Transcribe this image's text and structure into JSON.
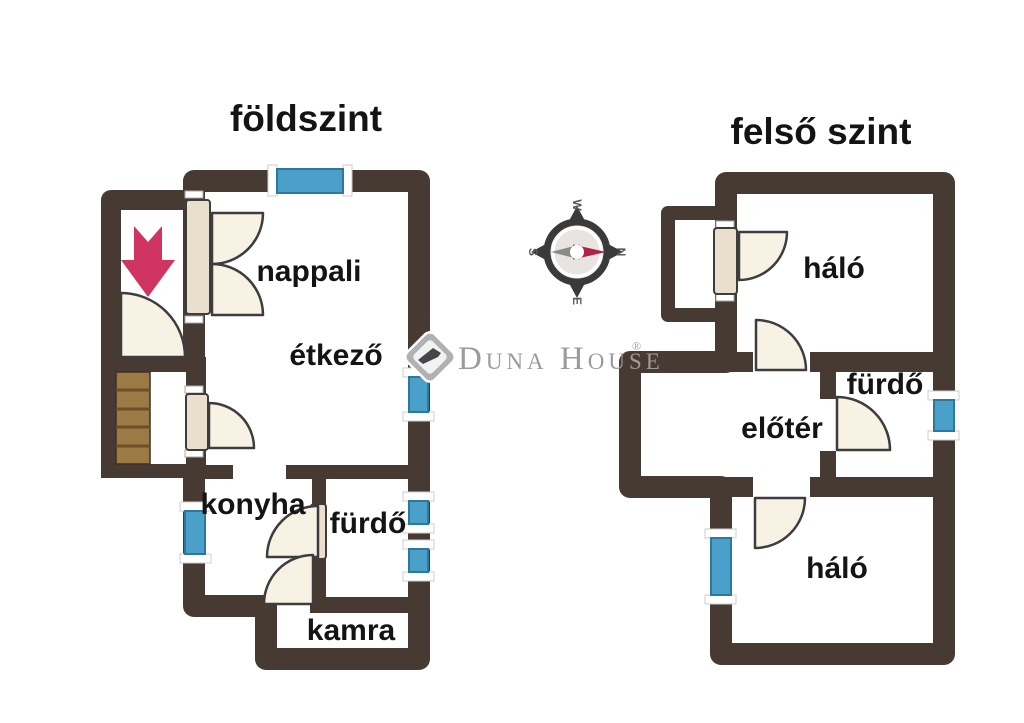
{
  "titles": {
    "ground": "földszint",
    "upper": "felső szint"
  },
  "rooms": {
    "nappali": "nappali",
    "etkezo": "étkező",
    "konyha": "konyha",
    "furdo_ground": "fürdő",
    "kamra": "kamra",
    "halo_upper_top": "háló",
    "eloter": "előtér",
    "furdo_upper": "fürdő",
    "halo_upper_bottom": "háló"
  },
  "compass": {
    "north": "N",
    "south": "S",
    "east": "E",
    "west": "W"
  },
  "watermark": {
    "brand": "Duna House",
    "registered": "®"
  },
  "colors": {
    "wall": "#473a32",
    "window": "#4aa0c8",
    "window_border": "#2e789f",
    "door_fill": "#f8f2e5",
    "door_panel": "#e9dfcc",
    "door_stroke": "#3d3d3d",
    "arrow": "#cf3560",
    "arrow_edge": "#b52a4e",
    "stairs": "#9b7a44",
    "stairs_line": "#6b4f28",
    "compass_dark": "#3a3a3a",
    "needle_red": "#b02346",
    "needle_gray": "#8a8a8a"
  }
}
